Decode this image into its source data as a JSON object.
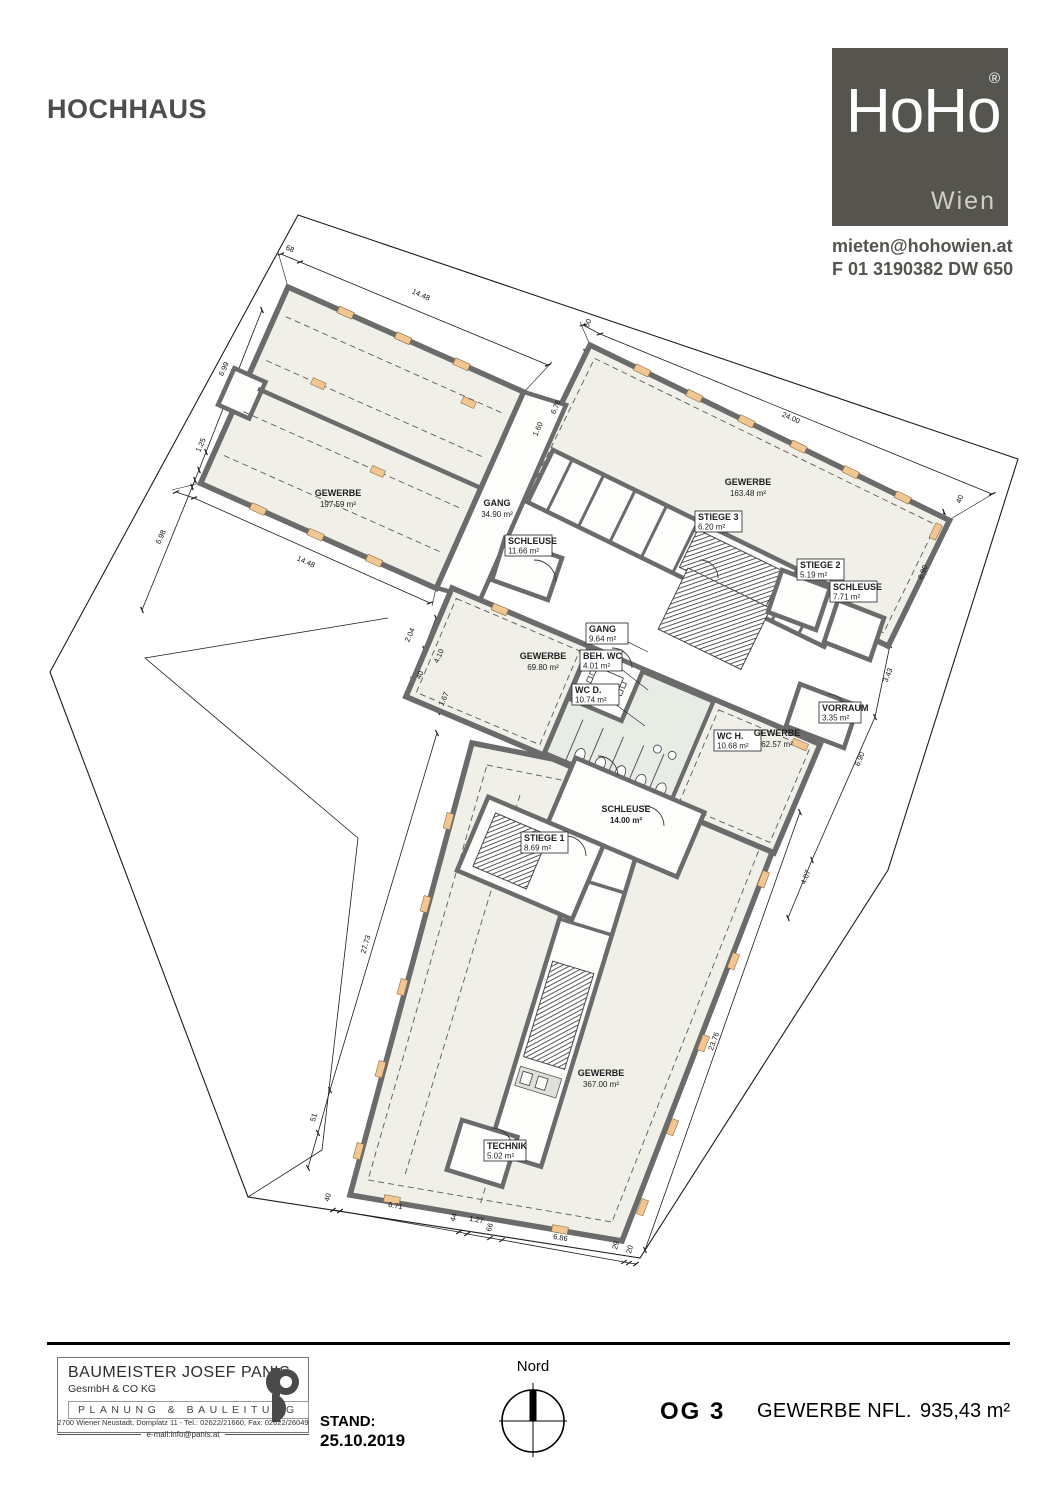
{
  "page": {
    "title": "HOCHHAUS"
  },
  "logo": {
    "brand": "HoHo",
    "registered": "®",
    "city": "Wien",
    "email": "mieten@hohowien.at",
    "phone": "F 01 3190382 DW 650"
  },
  "plan": {
    "colors": {
      "wall": "#6b6b6b",
      "room_fill": "#f0efe8",
      "wc_fill": "#e7ede5",
      "window_orange": "#f1c690",
      "line": "#1c1c1c",
      "logo_gray": "#55544e"
    },
    "rooms": [
      {
        "name": "GEWERBE",
        "area": "197.59 m²",
        "x": 338,
        "y": 498,
        "boxed": false
      },
      {
        "name": "GANG",
        "area": "34.90 m²",
        "x": 497,
        "y": 508,
        "boxed": false
      },
      {
        "name": "SCHLEUSE",
        "area": "11.66 m²",
        "x": 508,
        "y": 545,
        "boxed": true
      },
      {
        "name": "GEWERBE",
        "area": "163.48 m²",
        "x": 748,
        "y": 487,
        "boxed": false
      },
      {
        "name": "STIEGE 3",
        "area": "6.20 m²",
        "x": 698,
        "y": 521,
        "boxed": true
      },
      {
        "name": "STIEGE 2",
        "area": "5.19 m²",
        "x": 800,
        "y": 569,
        "boxed": true
      },
      {
        "name": "SCHLEUSE",
        "area": "7.71 m²",
        "x": 833,
        "y": 591,
        "boxed": true
      },
      {
        "name": "GANG",
        "area": "9.64 m²",
        "x": 589,
        "y": 633,
        "boxed": true
      },
      {
        "name": "GEWERBE",
        "area": "69.80 m²",
        "x": 543,
        "y": 661,
        "boxed": false
      },
      {
        "name": "BEH. WC",
        "area": "4.01 m²",
        "x": 583,
        "y": 660,
        "boxed": true
      },
      {
        "name": "WC D.",
        "area": "10.74 m²",
        "x": 575,
        "y": 694,
        "boxed": true
      },
      {
        "name": "WC H.",
        "area": "10.68 m²",
        "x": 717,
        "y": 740,
        "boxed": true
      },
      {
        "name": "GEWERBE",
        "area": "62.57 m²",
        "x": 777,
        "y": 738,
        "boxed": false
      },
      {
        "name": "VORRAUM",
        "area": "3.35 m²",
        "x": 822,
        "y": 712,
        "boxed": true
      },
      {
        "name": "SCHLEUSE",
        "area": "14.00 m²",
        "x": 626,
        "y": 814,
        "boxed": false,
        "bold": true
      },
      {
        "name": "STIEGE 1",
        "area": "8.69 m²",
        "x": 524,
        "y": 842,
        "boxed": true
      },
      {
        "name": "GEWERBE",
        "area": "367.00 m²",
        "x": 601,
        "y": 1078,
        "boxed": false
      },
      {
        "name": "TECHNIK",
        "area": "5.02 m²",
        "x": 487,
        "y": 1150,
        "boxed": true
      }
    ],
    "dimensions": [
      {
        "t": "68",
        "x": 289,
        "y": 251,
        "r": 24
      },
      {
        "t": "14.48",
        "x": 420,
        "y": 297,
        "r": 24
      },
      {
        "t": "6.99",
        "x": 226,
        "y": 370,
        "r": -66
      },
      {
        "t": "1.25",
        "x": 203,
        "y": 446,
        "r": -66
      },
      {
        "t": "6.98",
        "x": 163,
        "y": 538,
        "r": -66
      },
      {
        "t": "14.48",
        "x": 305,
        "y": 564,
        "r": 24
      },
      {
        "t": "50",
        "x": 590,
        "y": 324,
        "r": -66
      },
      {
        "t": "24.00",
        "x": 790,
        "y": 420,
        "r": 24
      },
      {
        "t": "6.76",
        "x": 558,
        "y": 408,
        "r": -66
      },
      {
        "t": "1.60",
        "x": 540,
        "y": 430,
        "r": -66
      },
      {
        "t": "2.04",
        "x": 412,
        "y": 636,
        "r": -66
      },
      {
        "t": "4.10",
        "x": 441,
        "y": 657,
        "r": -66
      },
      {
        "t": "40",
        "x": 422,
        "y": 676,
        "r": -66
      },
      {
        "t": "1.67",
        "x": 446,
        "y": 700,
        "r": -66
      },
      {
        "t": "40",
        "x": 962,
        "y": 500,
        "r": -68
      },
      {
        "t": "6.90",
        "x": 925,
        "y": 573,
        "r": -68
      },
      {
        "t": "3.43",
        "x": 890,
        "y": 676,
        "r": -68
      },
      {
        "t": "6.90",
        "x": 862,
        "y": 760,
        "r": -68
      },
      {
        "t": "4.07",
        "x": 808,
        "y": 878,
        "r": -68
      },
      {
        "t": "27.73",
        "x": 368,
        "y": 945,
        "r": -74
      },
      {
        "t": "51",
        "x": 316,
        "y": 1118,
        "r": -74
      },
      {
        "t": "23.76",
        "x": 716,
        "y": 1042,
        "r": -70
      },
      {
        "t": "40",
        "x": 330,
        "y": 1198,
        "r": -74
      },
      {
        "t": "6.71",
        "x": 395,
        "y": 1208,
        "r": 10
      },
      {
        "t": "44",
        "x": 456,
        "y": 1218,
        "r": -74
      },
      {
        "t": "1.27",
        "x": 476,
        "y": 1222,
        "r": 10
      },
      {
        "t": "66",
        "x": 492,
        "y": 1228,
        "r": -74
      },
      {
        "t": "6.86",
        "x": 560,
        "y": 1240,
        "r": 10
      },
      {
        "t": "29",
        "x": 618,
        "y": 1246,
        "r": -74
      },
      {
        "t": "20",
        "x": 632,
        "y": 1250,
        "r": -74
      }
    ]
  },
  "footer": {
    "firm": {
      "name": "BAUMEISTER JOSEF PANIS",
      "sub": "GesmbH & CO KG",
      "strip": "PLANUNG & BAULEITUNG",
      "address": "2700 Wiener Neustadt, Domplatz 11 - Tel.: 02622/21660, Fax: 02622/26049",
      "email": "e-mail:info@panis.at"
    },
    "stand_label": "STAND:",
    "stand_date": "25.10.2019",
    "north_label": "Nord",
    "floor": "OG 3",
    "area_label": "GEWERBE NFL.",
    "area_value": "935,43 m²"
  }
}
